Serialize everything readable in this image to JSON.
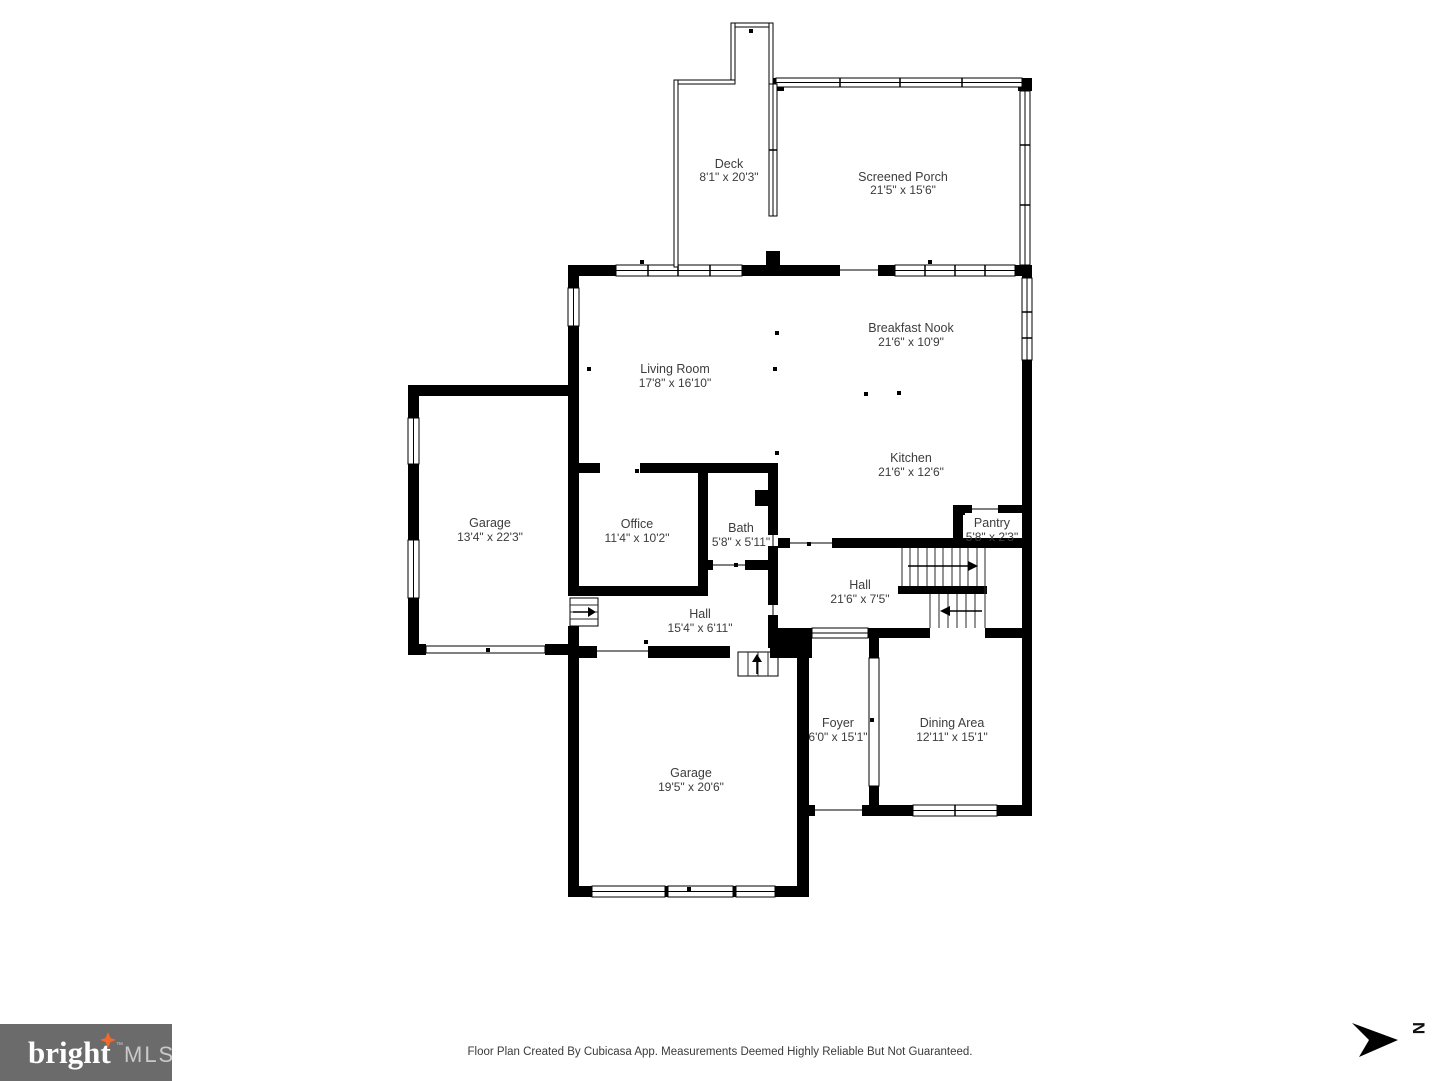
{
  "rooms": [
    {
      "name": "Deck",
      "dims": "8'1\" x 20'3\""
    },
    {
      "name": "Screened Porch",
      "dims": "21'5\" x 15'6\""
    },
    {
      "name": "Breakfast Nook",
      "dims": "21'6\" x 10'9\""
    },
    {
      "name": "Living Room",
      "dims": "17'8\" x 16'10\""
    },
    {
      "name": "Kitchen",
      "dims": "21'6\" x 12'6\""
    },
    {
      "name": "Garage",
      "dims": "13'4\" x 22'3\""
    },
    {
      "name": "Office",
      "dims": "11'4\" x 10'2\""
    },
    {
      "name": "Bath",
      "dims": "5'8\" x 5'11\""
    },
    {
      "name": "Pantry",
      "dims": "5'8\" x 2'3\""
    },
    {
      "name": "Hall",
      "dims": "21'6\" x 7'5\""
    },
    {
      "name": "Hall",
      "dims": "15'4\" x 6'11\""
    },
    {
      "name": "Foyer",
      "dims": "6'0\" x 15'1\""
    },
    {
      "name": "Dining Area",
      "dims": "12'11\" x 15'1\""
    },
    {
      "name": "Garage",
      "dims": "19'5\" x 20'6\""
    }
  ],
  "footer": {
    "logo": {
      "brand": "bright",
      "tm": "™",
      "suffix": "MLS"
    },
    "disclaimer": "Floor Plan Created By Cubicasa App. Measurements Deemed Highly Reliable But Not Guaranteed.",
    "compass_label": "N"
  },
  "colors": {
    "wall": "#000000",
    "label": "#3c3c3c",
    "logo_bg": "#6b6b6b",
    "logo_star": "#f16a2d"
  }
}
